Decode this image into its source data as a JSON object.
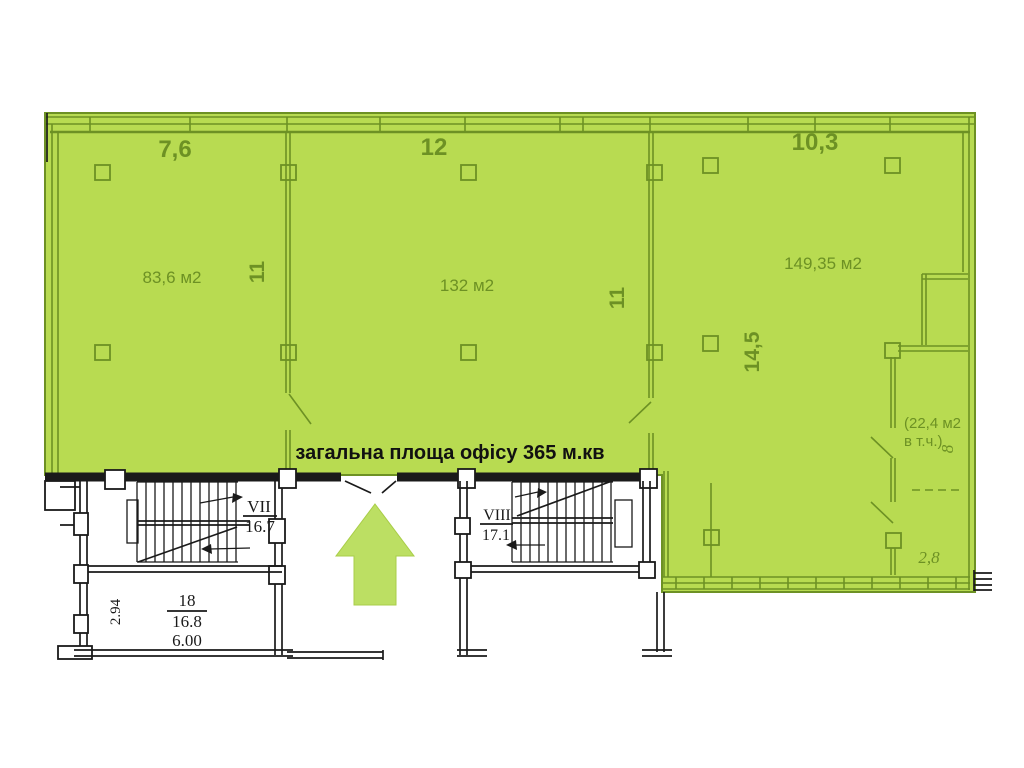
{
  "banner": {
    "label": "загальна площа офісу 365 м.кв"
  },
  "colors": {
    "office_green": "#b8db51",
    "wall_green": "#6d9124",
    "arrow_green": "#bcdf63",
    "ink": "#1a1a1a"
  },
  "dimensions": {
    "top_left": "7,6",
    "top_middle": "12",
    "top_right": "10,3",
    "wall1_depth": "11",
    "wall2_depth": "11",
    "right_depth": "14,5",
    "sub_depth": "8",
    "sub_width": "2,8"
  },
  "areas": {
    "room_left": "83,6 м2",
    "room_middle": "132 м2",
    "room_right": "149,35 м2",
    "sub_room_line1": "(22,4 м2",
    "sub_room_line2": "в т.ч.)"
  },
  "stairwells": {
    "left": {
      "numeral": "VII",
      "area": "16.7"
    },
    "right": {
      "numeral": "VIII",
      "area": "17.1"
    }
  },
  "lower_room": {
    "number": "18",
    "area": "16.8",
    "width": "6.00",
    "height": "2.94"
  }
}
